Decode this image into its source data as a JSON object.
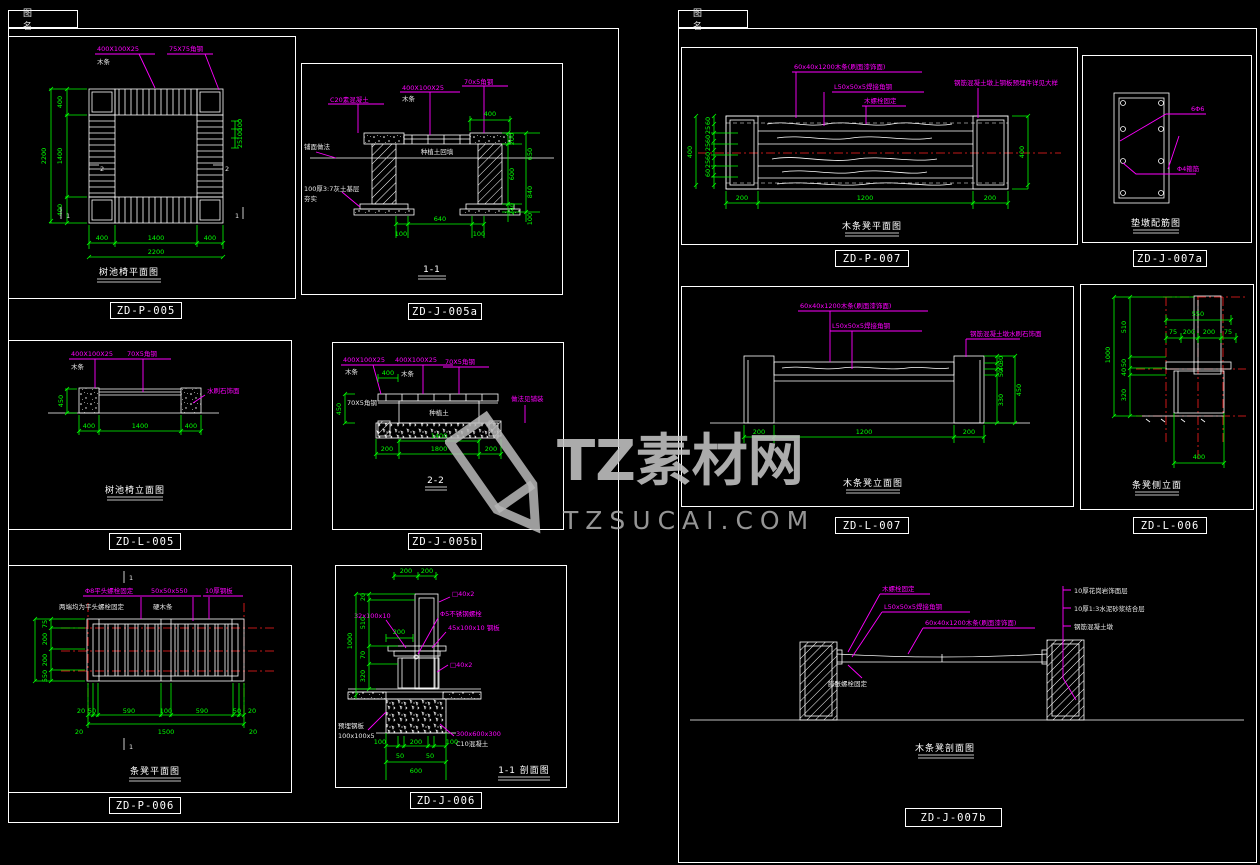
{
  "tabs": {
    "left": "图 名",
    "right": "图 名"
  },
  "watermark": {
    "brand": "TZ素材网",
    "url": "TZSUCAI.COM"
  },
  "colors": {
    "dim_green": "#00ff00",
    "leader_magenta": "#ff00ff",
    "line_white": "#ffffff",
    "centerline_red": "#ff2020",
    "background": "#000000",
    "watermark_gray": "#bdbdbd"
  },
  "panels": {
    "p005": {
      "code": "ZD-P-005",
      "title": "树池椅平面图",
      "ann": {
        "a1": "400X100X25",
        "a1b": "木条",
        "a2": "75X75角钢"
      },
      "marks": {
        "m1": "1",
        "m2": "2"
      },
      "dims": {
        "left": [
          "400",
          "1400",
          "400"
        ],
        "left_total": "2200",
        "bottom": [
          "400",
          "1400",
          "400"
        ],
        "bottom_total": "2200",
        "right": [
          "100",
          "100",
          "25"
        ]
      }
    },
    "j005a": {
      "code": "ZD-J-005a",
      "title": "1-1",
      "ann": {
        "a1": "C20素混凝土",
        "a2": "400X100X25",
        "a2b": "木条",
        "a3": "70x5角钢",
        "a4": "铺面做法",
        "a5": "100厚3:7灰土基层",
        "a5b": "夯实",
        "a6": "种植土回填"
      },
      "dims": {
        "top": "400",
        "inner": [
          "200",
          "600",
          "240"
        ],
        "outer": [
          "650",
          "840",
          "100"
        ],
        "bottom": [
          "100",
          "640",
          "100"
        ]
      }
    },
    "l005": {
      "code": "ZD-L-005",
      "title": "树池椅立面图",
      "ann": {
        "a1": "400X100X25",
        "a1b": "木条",
        "a2": "70X5角钢",
        "a3": "水刷石饰面"
      },
      "dims": {
        "left": "450",
        "bottom": [
          "400",
          "1400",
          "400"
        ]
      }
    },
    "j005b": {
      "code": "ZD-J-005b",
      "title": "2-2",
      "ann": {
        "a1": "400X100X25",
        "a1b": "木条",
        "a2": "400X100X25",
        "a2b": "木条",
        "a3": "70X5角钢",
        "a4": "70X5角钢",
        "a5": "种植土",
        "a6": "做法见铺装"
      },
      "dims": {
        "left": "450",
        "top": "400",
        "mid": "1400",
        "bottom": [
          "200",
          "1800",
          "200"
        ]
      }
    },
    "p006": {
      "code": "ZD-P-006",
      "title": "条凳平面图",
      "ann": {
        "a1": "Φ8平头螺栓固定",
        "a2": "两端均为平头螺栓固定",
        "a3": "50x50x550",
        "a3b": "硬木条",
        "a4": "10厚钢板"
      },
      "marks": {
        "m1": "1"
      },
      "dims": {
        "left": [
          "75",
          "200",
          "200",
          "75"
        ],
        "left_total": "550",
        "row1": [
          "20",
          "50",
          "590",
          "100",
          "590",
          "50",
          "20"
        ],
        "row2": [
          "20",
          "1500",
          "20"
        ]
      }
    },
    "j006": {
      "code": "ZD-J-006",
      "title": "1-1 剖面图",
      "ann": {
        "a1": "□40x2",
        "a2": "32x100x10",
        "a3": "Φ5不锈钢螺栓",
        "a4": "45x100x10 钢板",
        "a5": "□40x2",
        "a6": "预埋钢板",
        "a6b": "100x100x5",
        "a7": "300x600x300",
        "a7b": "C10混凝土"
      },
      "dims": {
        "top": [
          "200",
          "200"
        ],
        "left": [
          "20",
          "510",
          "70",
          "320"
        ],
        "left_total": "1000",
        "seat": "200",
        "bottom": [
          "100",
          "200",
          "100"
        ],
        "bottom_small": [
          "50",
          "50"
        ],
        "bottom_total": "600"
      }
    },
    "p007": {
      "code": "ZD-P-007",
      "title": "木条凳平面图",
      "ann": {
        "a1": "60x40x1200木条(刷面漆饰面)",
        "a2": "L50x50x5焊接角钢",
        "a3": "木螺栓固定",
        "a4": "钢筋混凝土墩上钢板预埋件详见大样"
      },
      "dims": {
        "left": [
          "60",
          "25",
          "60",
          "25",
          "60",
          "25",
          "60"
        ],
        "left_total": "400",
        "right": "400",
        "bottom": [
          "200",
          "1200",
          "200"
        ]
      }
    },
    "j007a": {
      "code": "ZD-J-007a",
      "title": "垫墩配筋图",
      "ann": {
        "a1": "6Φ6",
        "a2": "Φ4箍筋"
      }
    },
    "l007": {
      "code": "ZD-L-007",
      "title": "木条凳立面图",
      "ann": {
        "a1": "60x40x1200木条(刷面漆饰面)",
        "a2": "L50x50x5焊接角钢",
        "a3": "钢筋混凝土墩水刷石饰面"
      },
      "dims": {
        "right": [
          "30",
          "40",
          "50",
          "330"
        ],
        "right_total": "450",
        "bottom": [
          "200",
          "1200",
          "200"
        ]
      }
    },
    "l006": {
      "code": "ZD-L-006",
      "title": "条凳侧立面",
      "dims": {
        "top": "550",
        "row": [
          "75",
          "200",
          "200",
          "75"
        ],
        "left": [
          "510",
          "50",
          "40",
          "320"
        ],
        "left_total": "1000",
        "bottom": "400"
      }
    },
    "j007b": {
      "code": "ZD-J-007b",
      "title": "木条凳剖面图",
      "ann": {
        "a1": "木螺栓固定",
        "a2": "L50x50x5焊接角钢",
        "a3": "60x40x1200木条(刷面漆饰面)",
        "a4": "膨胀螺栓固定",
        "b1": "10厚花岗岩饰面层",
        "b2": "10厚1:3水泥砂浆结合层",
        "b3": "钢筋混凝土墩"
      }
    }
  }
}
